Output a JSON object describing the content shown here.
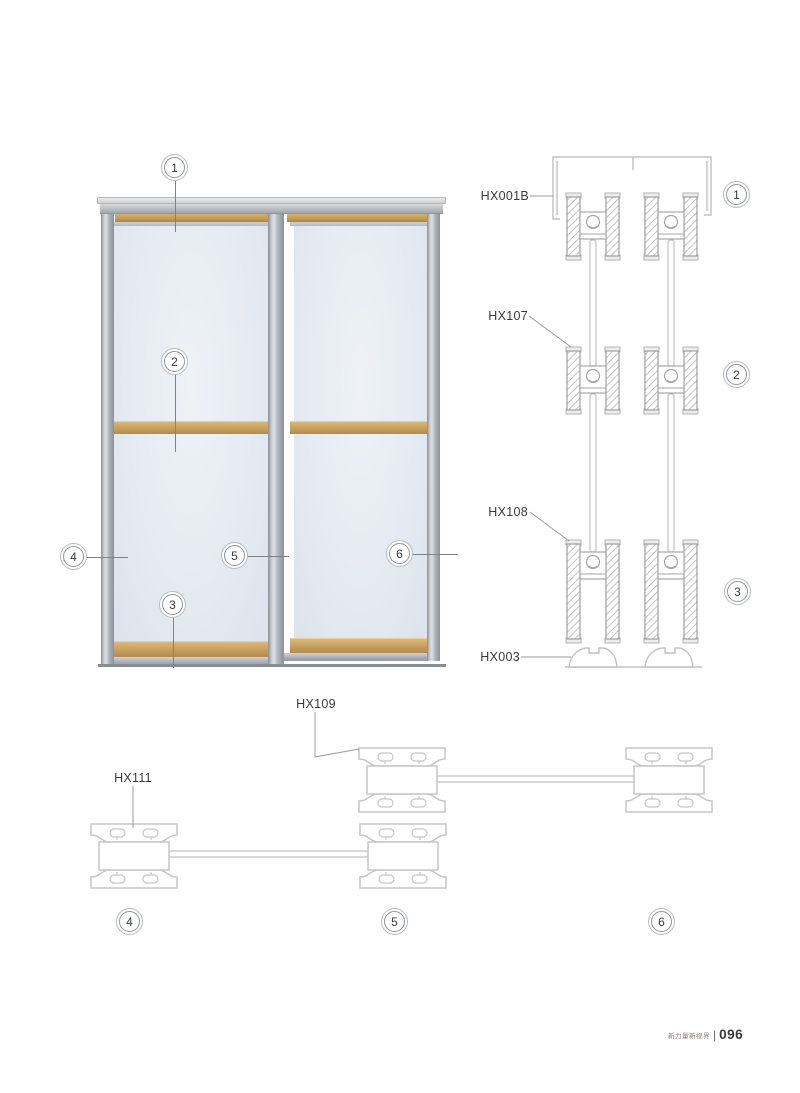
{
  "labels": {
    "hx001b": "HX001B",
    "hx107": "HX107",
    "hx108": "HX108",
    "hx003": "HX003",
    "hx109": "HX109",
    "hx111": "HX111"
  },
  "callouts": {
    "n1": "1",
    "n2": "2",
    "n3": "3",
    "n4": "4",
    "n5": "5",
    "n6": "6"
  },
  "footer": {
    "caption": "新力量新视界",
    "divider": "|",
    "page_number": "096"
  },
  "colors": {
    "wood": "#c49d57",
    "aluminum": "#aeb3ba",
    "glass": "#e8edf4",
    "drawing_line": "#c6c6c6",
    "hatch_line": "#9e9e9e",
    "text": "#3a3a3a"
  }
}
